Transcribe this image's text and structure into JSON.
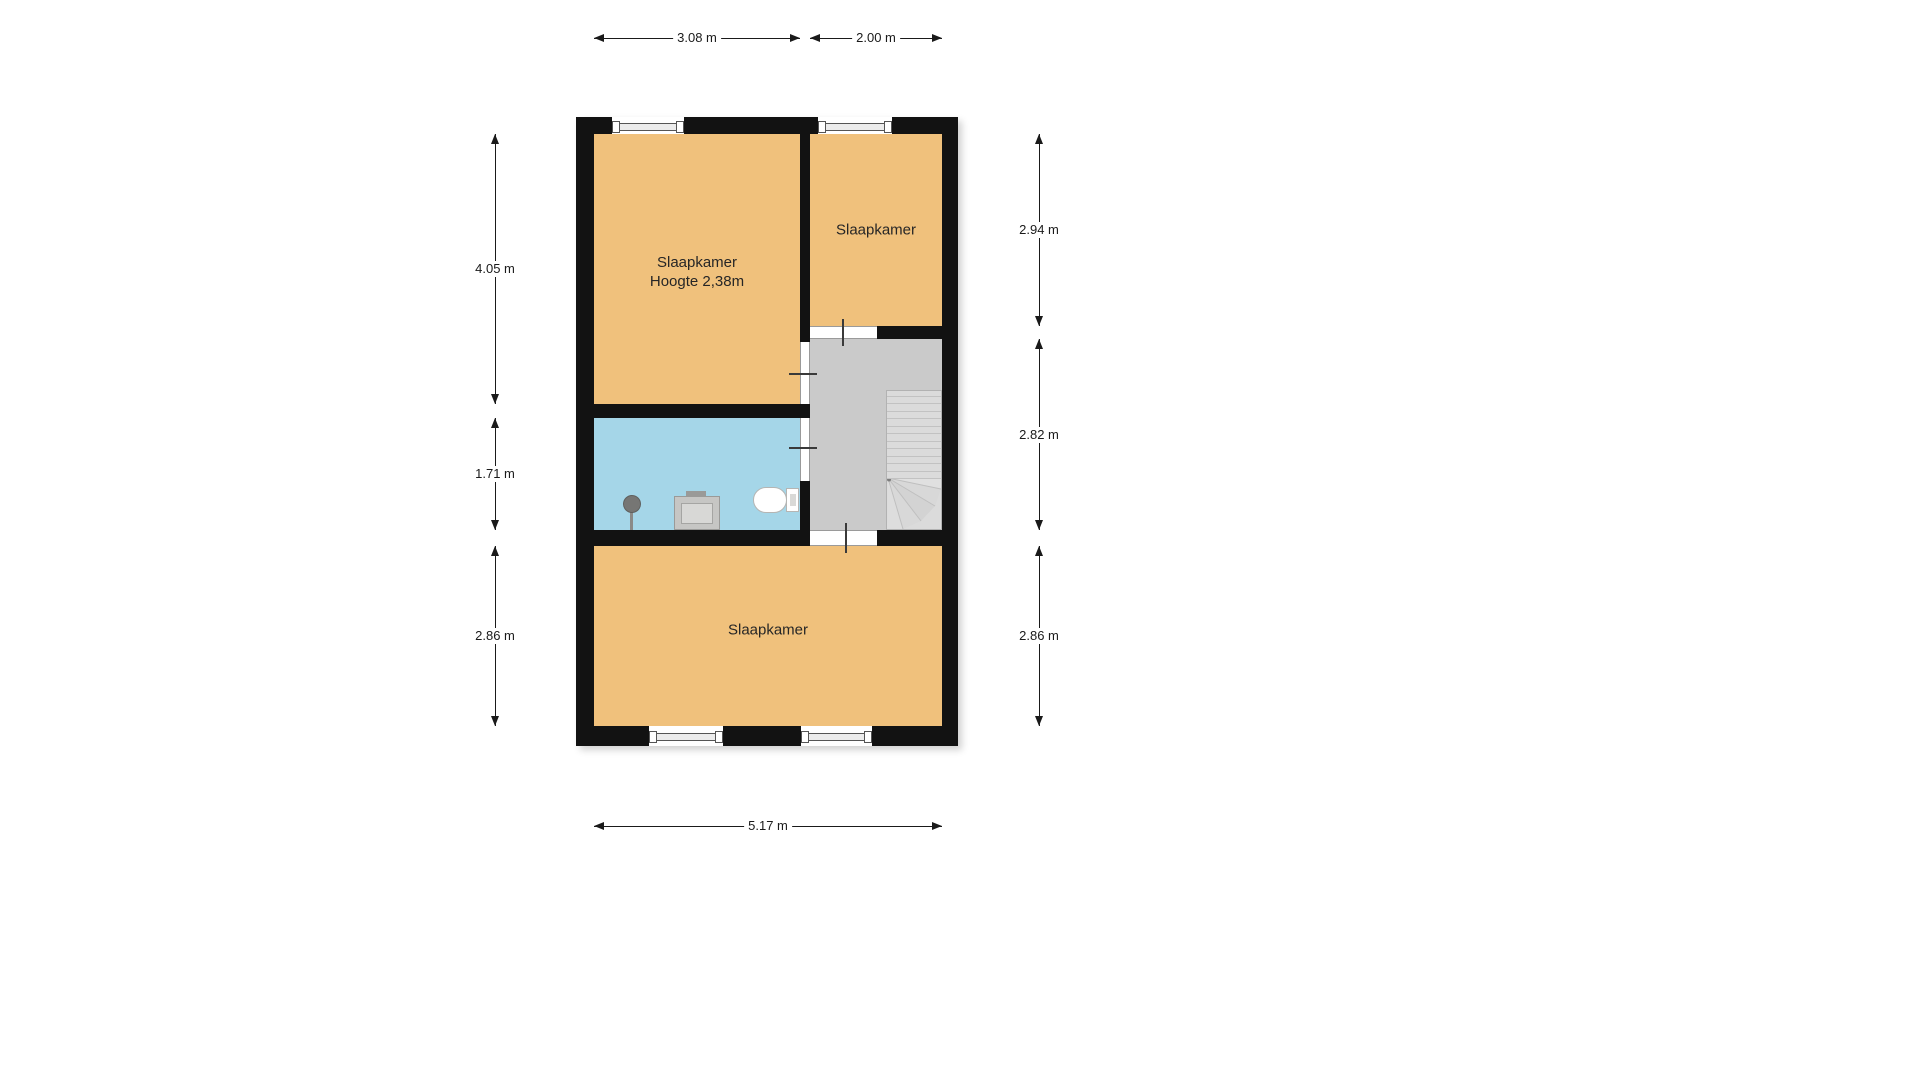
{
  "floorplan": {
    "rooms": {
      "bedroom_top_left": {
        "label": "Slaapkamer",
        "height_note": "Hoogte 2,38m"
      },
      "bedroom_top_right": {
        "label": "Slaapkamer"
      },
      "bedroom_bottom": {
        "label": "Slaapkamer"
      }
    },
    "dimensions": {
      "top_left_width": "3.08 m",
      "top_right_width": "2.00 m",
      "left_top_height": "4.05 m",
      "left_middle_height": "1.71 m",
      "left_bottom_height": "2.86 m",
      "right_top_height": "2.94 m",
      "right_middle_height": "2.82 m",
      "right_bottom_height": "2.86 m",
      "bottom_width": "5.17 m"
    },
    "colors": {
      "wall": "#121212",
      "bedroom_fill": "#F0C17C",
      "bathroom_fill": "#A5D6E8",
      "landing_fill": "#CACACA",
      "stairs_fill": "#DBDBDB"
    }
  }
}
